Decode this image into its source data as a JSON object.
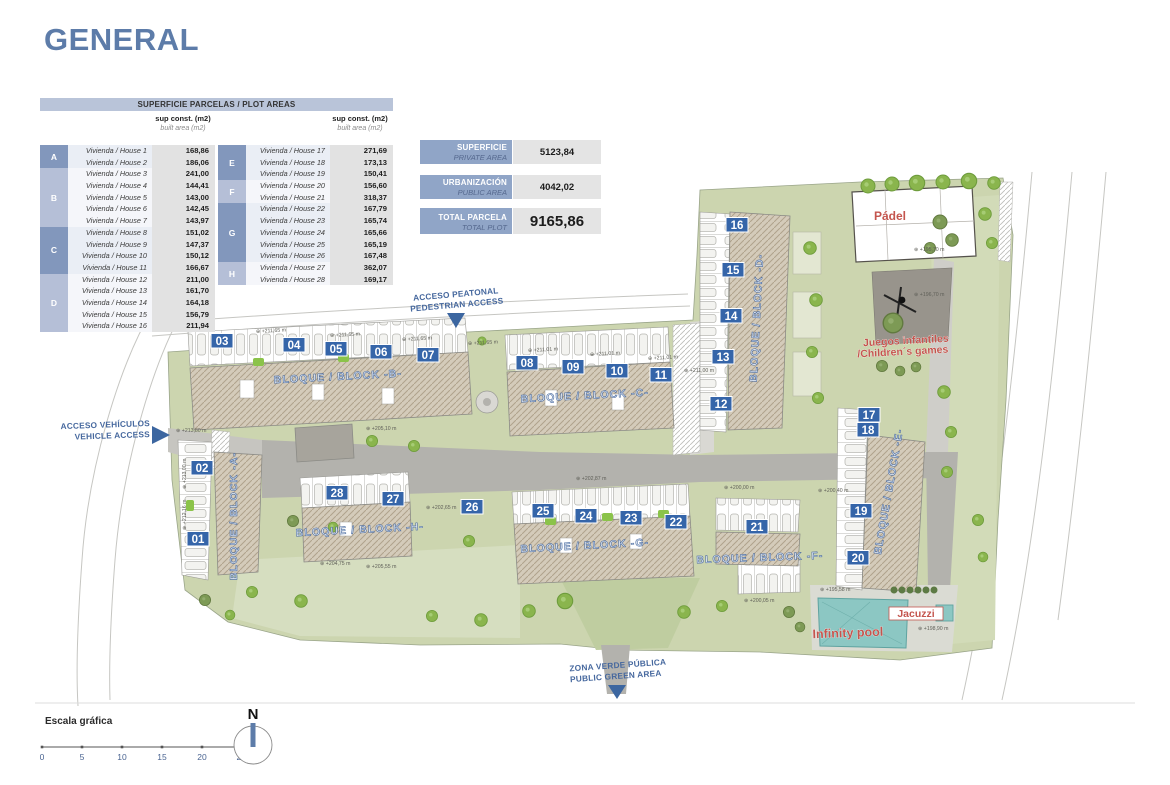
{
  "title": "GENERAL",
  "colors": {
    "accent_blue": "#5d7ca9",
    "table_header_bg": "#b9c4d9",
    "group_dark": "#8297bc",
    "group_light": "#b5bfd7",
    "badge_blue": "#3565a9",
    "label_red": "#c4554e",
    "access_blue": "#46689e",
    "site_green": "#ccd5af",
    "pool_teal": "#8cc7c3"
  },
  "table": {
    "header": "SUPERFICIE PARCELAS / PLOT AREAS",
    "sup_header": "sup const. (m2)",
    "built_header": "built area (m2)",
    "left_groups": [
      {
        "letter": "A",
        "shade": "dark",
        "rows": [
          [
            "Vivienda / House 1",
            "168,86"
          ],
          [
            "Vivienda / House 2",
            "186,06"
          ]
        ]
      },
      {
        "letter": "B",
        "shade": "light",
        "rows": [
          [
            "Vivienda / House 3",
            "241,00"
          ],
          [
            "Vivienda / House 4",
            "144,41"
          ],
          [
            "Vivienda / House 5",
            "143,00"
          ],
          [
            "Vivienda / House 6",
            "142,45"
          ],
          [
            "Vivienda / House 7",
            "143,97"
          ]
        ]
      },
      {
        "letter": "C",
        "shade": "dark",
        "rows": [
          [
            "Vivienda / House 8",
            "151,02"
          ],
          [
            "Vivienda / House 9",
            "147,37"
          ],
          [
            "Vivienda / House 10",
            "150,12"
          ],
          [
            "Vivienda / House 11",
            "166,67"
          ]
        ]
      },
      {
        "letter": "D",
        "shade": "light",
        "rows": [
          [
            "Vivienda / House 12",
            "211,00"
          ],
          [
            "Vivienda / House 13",
            "161,70"
          ],
          [
            "Vivienda / House 14",
            "164,18"
          ],
          [
            "Vivienda / House 15",
            "156,79"
          ],
          [
            "Vivienda / House 16",
            "211,94"
          ]
        ]
      }
    ],
    "right_groups": [
      {
        "letter": "E",
        "shade": "dark",
        "rows": [
          [
            "Vivienda / House 17",
            "271,69"
          ],
          [
            "Vivienda / House 18",
            "173,13"
          ],
          [
            "Vivienda / House 19",
            "150,41"
          ]
        ]
      },
      {
        "letter": "F",
        "shade": "light",
        "rows": [
          [
            "Vivienda / House 20",
            "156,60"
          ],
          [
            "Vivienda / House 21",
            "318,37"
          ]
        ]
      },
      {
        "letter": "G",
        "shade": "dark",
        "rows": [
          [
            "Vivienda / House 22",
            "167,79"
          ],
          [
            "Vivienda / House 23",
            "165,74"
          ],
          [
            "Vivienda / House 24",
            "165,66"
          ],
          [
            "Vivienda / House 25",
            "165,19"
          ],
          [
            "Vivienda / House 26",
            "167,48"
          ]
        ]
      },
      {
        "letter": "H",
        "shade": "light",
        "rows": [
          [
            "Vivienda / House 27",
            "362,07"
          ],
          [
            "Vivienda / House 28",
            "169,17"
          ]
        ]
      }
    ]
  },
  "summary": [
    {
      "es": "SUPERFICIE",
      "en": "PRIVATE AREA",
      "value": "5123,84"
    },
    {
      "es": "URBANIZACIÓN",
      "en": "PUBLIC AREA",
      "value": "4042,02"
    },
    {
      "es": "TOTAL PARCELA",
      "en": "TOTAL PLOT",
      "value": "9165,86"
    }
  ],
  "plan": {
    "access": [
      {
        "line1": "ACCESO PEATONAL",
        "line2": "PEDESTRIAN ACCESS"
      },
      {
        "line1": "ACCESO VEHÍCULOS",
        "line2": "VEHICLE ACCESS"
      },
      {
        "line1": "ZONA VERDE PÚBLICA",
        "line2": "PUBLIC GREEN AREA"
      }
    ],
    "areas": [
      {
        "text": "Pádel"
      },
      {
        "text": "Juegos infantiles"
      },
      {
        "text": "/Children´s games"
      },
      {
        "text": "Infinity pool"
      },
      {
        "text": "Jacuzzi"
      }
    ],
    "blocks": [
      "BLOQUE / BLOCK -A-",
      "BLOQUE / BLOCK -B-",
      "BLOQUE / BLOCK -C-",
      "BLOQUE / BLOCK -D-",
      "BLOQUE / BLOCK -E-",
      "BLOQUE / BLOCK -F-",
      "BLOQUE / BLOCK -G-",
      "BLOQUE / BLOCK -H-"
    ],
    "badges": [
      {
        "n": "01",
        "x": 198,
        "y": 539
      },
      {
        "n": "02",
        "x": 202,
        "y": 468
      },
      {
        "n": "03",
        "x": 222,
        "y": 341
      },
      {
        "n": "04",
        "x": 294,
        "y": 345
      },
      {
        "n": "05",
        "x": 336,
        "y": 349
      },
      {
        "n": "06",
        "x": 381,
        "y": 352
      },
      {
        "n": "07",
        "x": 428,
        "y": 355
      },
      {
        "n": "08",
        "x": 527,
        "y": 363
      },
      {
        "n": "09",
        "x": 573,
        "y": 367
      },
      {
        "n": "10",
        "x": 617,
        "y": 371
      },
      {
        "n": "11",
        "x": 661,
        "y": 375
      },
      {
        "n": "12",
        "x": 721,
        "y": 404
      },
      {
        "n": "13",
        "x": 723,
        "y": 357
      },
      {
        "n": "14",
        "x": 731,
        "y": 316
      },
      {
        "n": "15",
        "x": 733,
        "y": 270
      },
      {
        "n": "16",
        "x": 737,
        "y": 225
      },
      {
        "n": "17",
        "x": 869,
        "y": 415
      },
      {
        "n": "18",
        "x": 868,
        "y": 430
      },
      {
        "n": "19",
        "x": 861,
        "y": 511
      },
      {
        "n": "20",
        "x": 858,
        "y": 558
      },
      {
        "n": "21",
        "x": 757,
        "y": 527
      },
      {
        "n": "22",
        "x": 676,
        "y": 522
      },
      {
        "n": "23",
        "x": 631,
        "y": 518
      },
      {
        "n": "24",
        "x": 586,
        "y": 516
      },
      {
        "n": "25",
        "x": 543,
        "y": 511
      },
      {
        "n": "26",
        "x": 472,
        "y": 507
      },
      {
        "n": "27",
        "x": 393,
        "y": 499
      },
      {
        "n": "28",
        "x": 337,
        "y": 493
      }
    ],
    "elevations": [
      {
        "t": "+211,65 m",
        "x": 256,
        "y": 333,
        "r": -3
      },
      {
        "t": "+211,65 m",
        "x": 330,
        "y": 337,
        "r": -3
      },
      {
        "t": "+211,65 m",
        "x": 402,
        "y": 341,
        "r": -3
      },
      {
        "t": "+211,65 m",
        "x": 468,
        "y": 345,
        "r": -3
      },
      {
        "t": "+211,01 m",
        "x": 528,
        "y": 352,
        "r": -3
      },
      {
        "t": "+211,01 m",
        "x": 590,
        "y": 356,
        "r": -3
      },
      {
        "t": "+211,01 m",
        "x": 648,
        "y": 360,
        "r": -3
      },
      {
        "t": "+211,00 m",
        "x": 684,
        "y": 372,
        "r": 0
      },
      {
        "t": "+213,80 m",
        "x": 176,
        "y": 432,
        "r": 0
      },
      {
        "t": "+213,00 m",
        "x": 186,
        "y": 489,
        "r": -90
      },
      {
        "t": "+212,16 m",
        "x": 186,
        "y": 530,
        "r": -90
      },
      {
        "t": "+205,10 m",
        "x": 366,
        "y": 430,
        "r": 0
      },
      {
        "t": "+202,87 m",
        "x": 576,
        "y": 480,
        "r": 0
      },
      {
        "t": "+202,65 m",
        "x": 426,
        "y": 509,
        "r": 0
      },
      {
        "t": "+200,00 m",
        "x": 724,
        "y": 489,
        "r": 0
      },
      {
        "t": "+200,40 m",
        "x": 818,
        "y": 492,
        "r": 0
      },
      {
        "t": "+204,75 m",
        "x": 320,
        "y": 565,
        "r": 0
      },
      {
        "t": "+205,55 m",
        "x": 366,
        "y": 568,
        "r": 0
      },
      {
        "t": "+200,05 m",
        "x": 744,
        "y": 602,
        "r": 0
      },
      {
        "t": "+195,58 m",
        "x": 820,
        "y": 591,
        "r": 0
      },
      {
        "t": "+198,90 m",
        "x": 918,
        "y": 630,
        "r": 0
      },
      {
        "t": "+195,70 m",
        "x": 914,
        "y": 251,
        "r": 0
      },
      {
        "t": "+196,70 m",
        "x": 914,
        "y": 296,
        "r": 0
      }
    ]
  },
  "footer": {
    "scale_label": "Escala gráfica",
    "ticks": [
      "0",
      "5",
      "10",
      "15",
      "20",
      "25 m"
    ],
    "north": "N"
  }
}
